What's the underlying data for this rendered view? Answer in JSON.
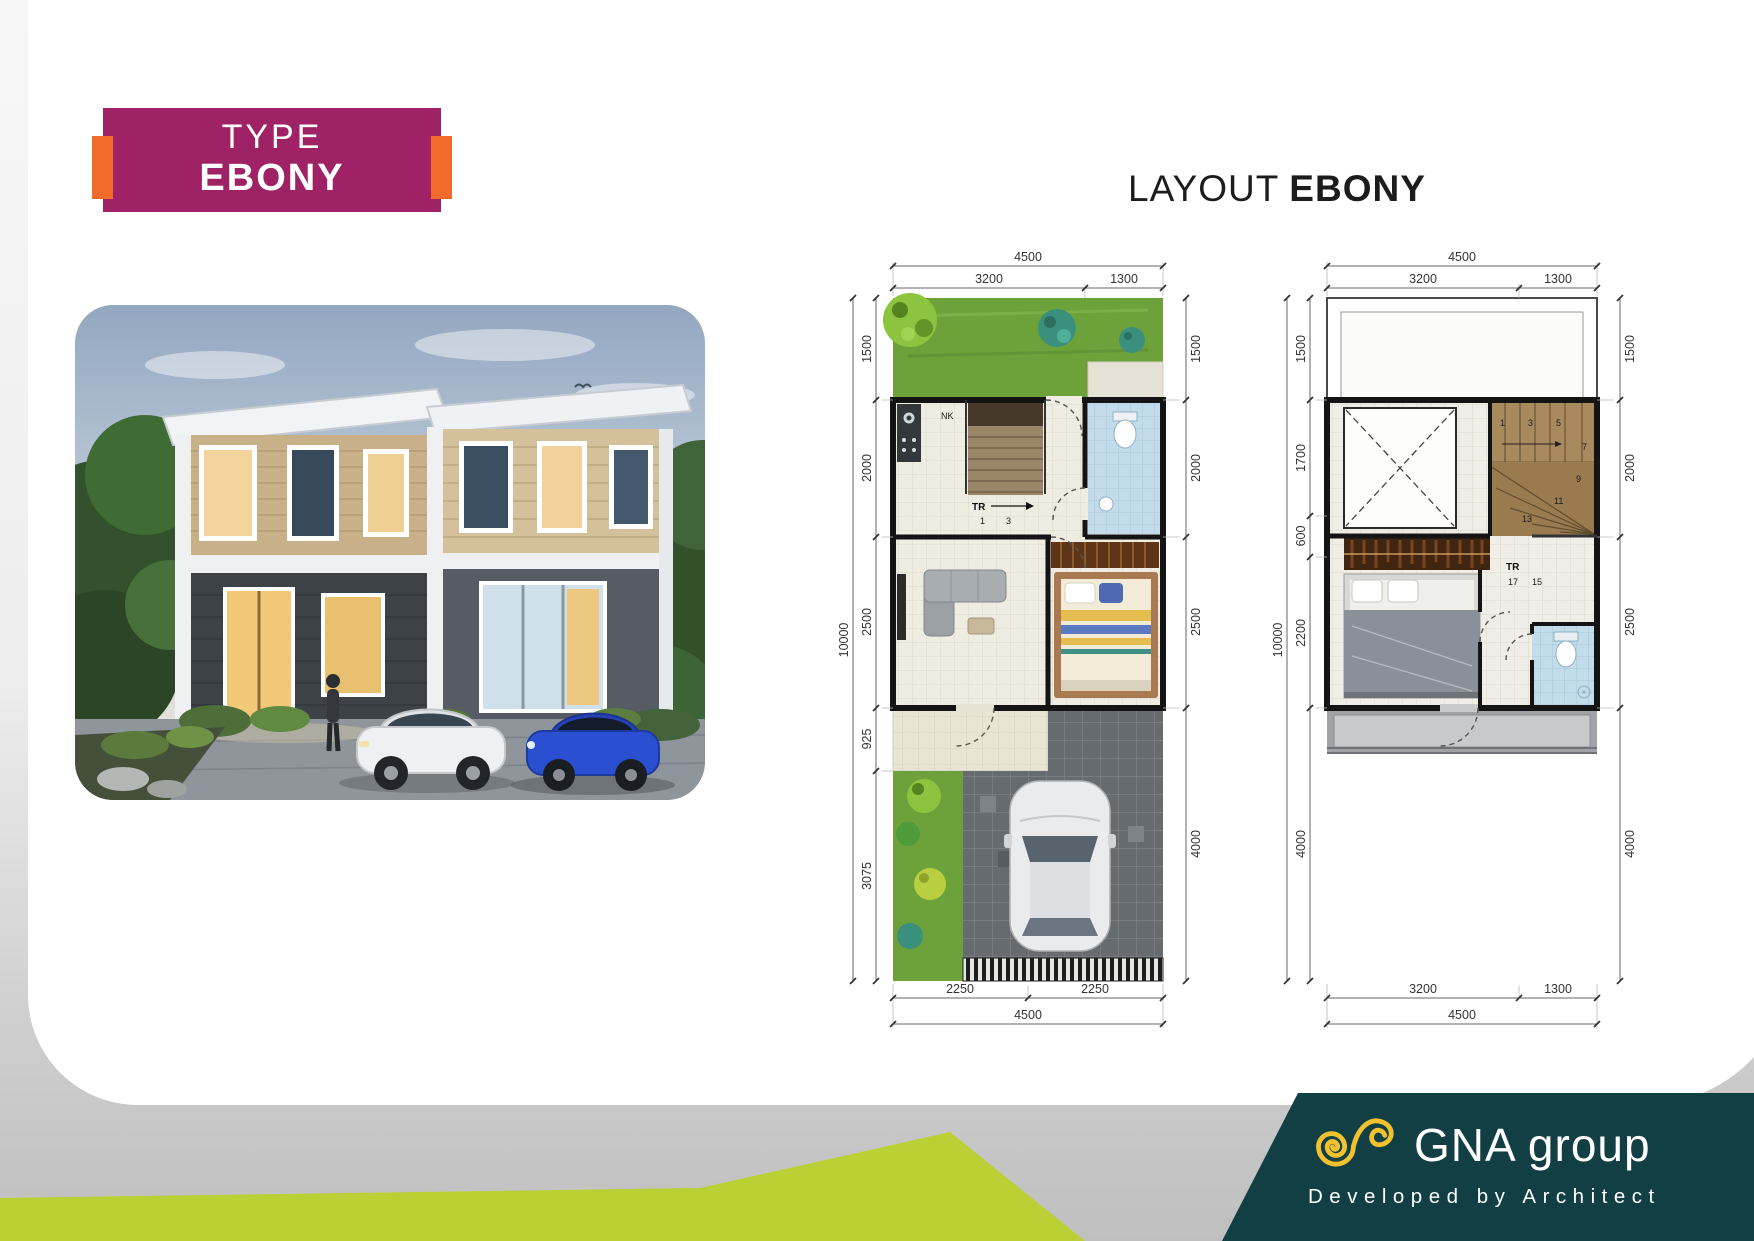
{
  "badge": {
    "line1": "TYPE",
    "line2": "EBONY"
  },
  "layout_title": {
    "prefix": "LAYOUT",
    "name": "EBONY"
  },
  "colors": {
    "badge_magenta": "#9e2265",
    "accent_orange": "#f26b2b",
    "stripe_green": "#bccf35",
    "footer_teal": "#123f44",
    "logo_yellow": "#f2c22e"
  },
  "plan1": {
    "top": {
      "overall": "4500",
      "a": "3200",
      "b": "1300"
    },
    "left": {
      "overall": "10000",
      "segs": [
        "1500",
        "2000",
        "2500",
        "925",
        "3075"
      ]
    },
    "right": {
      "segs": [
        "1500",
        "2000",
        "2500",
        "4000"
      ]
    },
    "bottom": {
      "a": "2250",
      "b": "2250",
      "overall": "4500"
    },
    "labels": {
      "entry": "NK",
      "stair": "TR",
      "s1": "1",
      "s2": "3"
    }
  },
  "plan2": {
    "top": {
      "overall": "4500",
      "a": "3200",
      "b": "1300"
    },
    "left": {
      "overall": "10000",
      "segs": [
        "1500",
        "1700",
        "600",
        "2200",
        "4000"
      ]
    },
    "right": {
      "segs": [
        "1500",
        "2000",
        "2500",
        "4000"
      ]
    },
    "bottom": {
      "a": "3200",
      "b": "1300",
      "overall": "4500"
    },
    "labels": {
      "stair": "TR",
      "level": "17",
      "mid": "15",
      "steps": [
        "1",
        "3",
        "5",
        "7",
        "9",
        "11",
        "13"
      ]
    }
  },
  "footer": {
    "brand": "GNA group",
    "tagline": "Developed by Architect"
  }
}
